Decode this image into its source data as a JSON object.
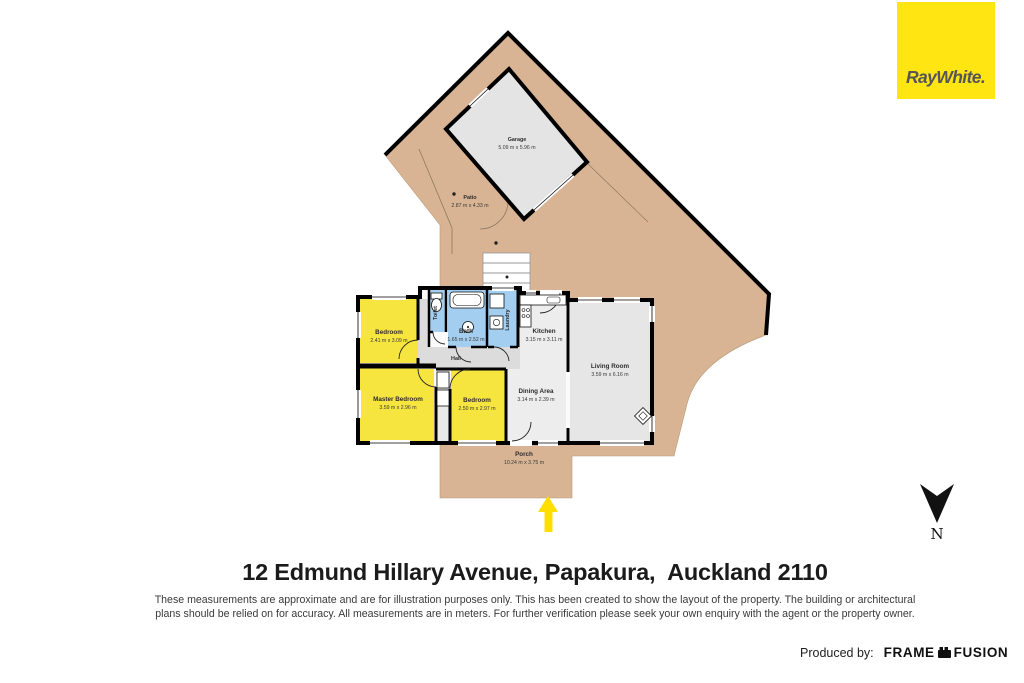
{
  "branding": {
    "raywhite": "RayWhite.",
    "raywhite_bg": "#FFE512"
  },
  "title": "12 Edmund Hillary Avenue, Papakura,  Auckland 2110",
  "disclaimer": {
    "line1": "These measurements are approximate and are for illustration purposes only. This has been created to show the layout of the property. The building or architectural",
    "line2": "plans should be relied on for accuracy. All measurements are in meters. For further verification please seek your own enquiry with the agent or the property owner."
  },
  "footer": {
    "produced_by": "Produced by:",
    "producer_brand_1": "FRAME",
    "producer_brand_2": "FUSION"
  },
  "compass": {
    "north": "N"
  },
  "floorplan": {
    "colors": {
      "deck_tan": "#D8B494",
      "bedroom_yellow": "#F6E43F",
      "wet_area_blue": "#A3CEEF",
      "room_gray": "#E6E6E6",
      "wall_black": "#000000",
      "entry_arrow_yellow": "#FFDE00"
    },
    "rooms": [
      {
        "name": "Garage",
        "dims": "5.09 m x 5.96 m"
      },
      {
        "name": "Patio",
        "dims": "2.87 m x 4.33 m"
      },
      {
        "name": "Bedroom",
        "dims": "2.41 m x 3.09 m"
      },
      {
        "name": "Toilet",
        "dims": ""
      },
      {
        "name": "Bath",
        "dims": "1.65 m x 2.52 m"
      },
      {
        "name": "Laundry",
        "dims": ""
      },
      {
        "name": "Kitchen",
        "dims": "3.15 m x 3.11 m"
      },
      {
        "name": "Living Room",
        "dims": "3.59 m x 6.16 m"
      },
      {
        "name": "Hall",
        "dims": ""
      },
      {
        "name": "Master Bedroom",
        "dims": "3.59 m x 2.96 m"
      },
      {
        "name": "Bedroom",
        "dims": "2.50 m x 2.97 m"
      },
      {
        "name": "Dining Area",
        "dims": "3.14 m x 2.39 m"
      },
      {
        "name": "Porch",
        "dims": "10.24 m x 3.75 m"
      }
    ]
  }
}
